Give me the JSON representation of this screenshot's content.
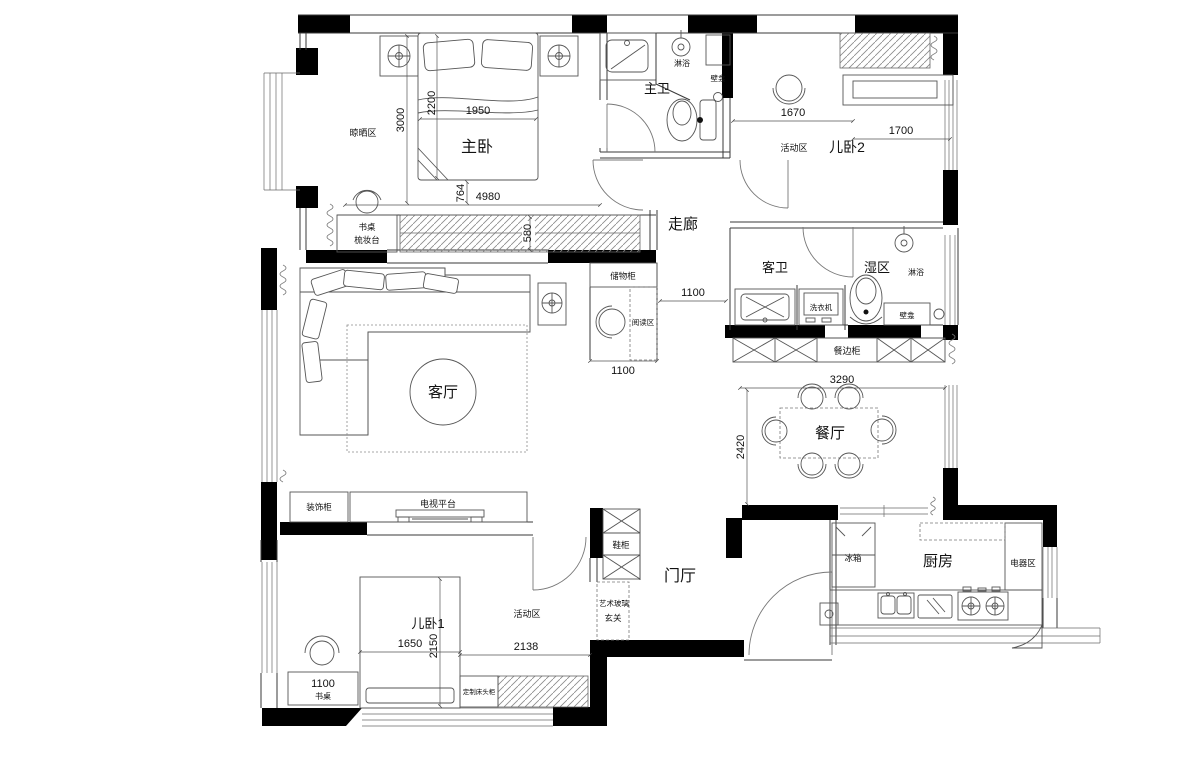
{
  "labels": {
    "master_bedroom": "主卧",
    "master_bath": "主卫",
    "kids_bedroom_2": "儿卧2",
    "corridor": "走廊",
    "guest_bath": "客卫",
    "wet_area": "湿区",
    "living_room": "客厅",
    "dining_room": "餐厅",
    "entry_hall": "门厅",
    "kitchen": "厨房",
    "kids_bedroom_1": "儿卧1",
    "drying_area": "晾晒区",
    "activity_area_kids2": "活动区",
    "activity_area_kids1": "活动区",
    "reading_area": "阅读区",
    "foyer": "玄关",
    "shower_master": "淋浴",
    "niche_master": "壁龛",
    "shower_wet": "淋浴",
    "niche_wet": "壁龛",
    "desk_line": "书桌",
    "dresser_line": "梳妆台",
    "storage_cabinet": "储物柜",
    "washing_machine": "洗衣机",
    "sideboard": "餐边柜",
    "decor_cabinet": "装饰柜",
    "tv_platform": "电视平台",
    "shoe_cabinet": "鞋柜",
    "art_glass": "艺术玻璃",
    "fridge": "冰箱",
    "appliance_area": "电器区",
    "desk_kids1": "书桌",
    "custom_headboard": "定制床头柜"
  },
  "dimensions": {
    "master_room_depth": "3000",
    "master_bed_length": "2200",
    "master_bed_width": "1950",
    "master_gap": "764",
    "master_room_width": "4980",
    "wardrobe_depth": "580",
    "kids2_activity_width": "1670",
    "kids2_bed_width": "1700",
    "corridor_width": "1100",
    "reading_area_width": "1100",
    "sideboard_width": "3290",
    "dining_depth": "2420",
    "kids1_bed_width": "1650",
    "kids1_bed_length": "2150",
    "kids1_activity_width": "2138",
    "kids1_desk_width": "1100"
  }
}
